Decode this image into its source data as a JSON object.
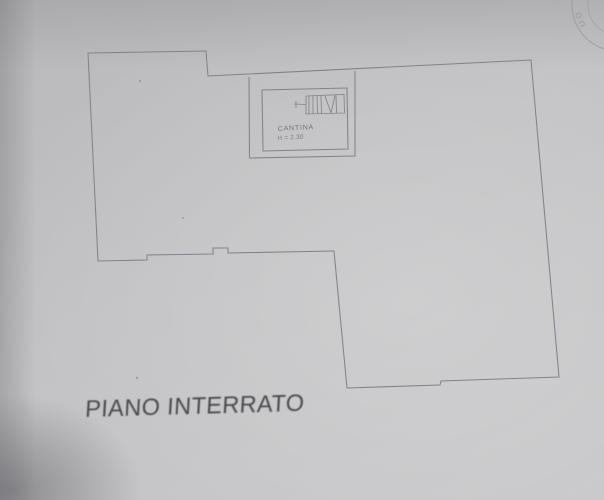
{
  "document": {
    "title": "PIANO INTERRATO",
    "room": {
      "name": "CANTINA",
      "height_label": "H = 2.30"
    },
    "stamp": {
      "visible_letters": "UO"
    },
    "colors": {
      "paper": "#c2c2c4",
      "ink": "#82828a",
      "title_ink": "#4b4b4d"
    }
  }
}
